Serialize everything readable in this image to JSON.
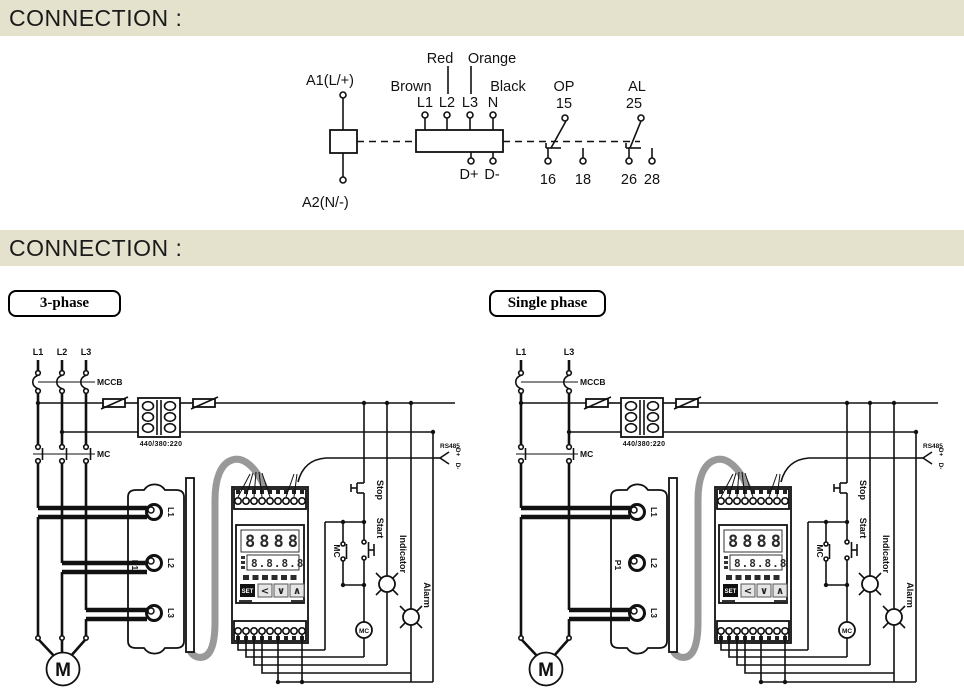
{
  "header": {
    "title": "CONNECTION :"
  },
  "section_tags": {
    "three_phase": "3-phase",
    "single_phase": "Single phase"
  },
  "top_diagram": {
    "supply_top": "A1(L/+)",
    "supply_bottom": "A2(N/-)",
    "color_brown": "Brown",
    "color_red": "Red",
    "color_orange": "Orange",
    "color_black": "Black",
    "t_l1": "L1",
    "t_l2": "L2",
    "t_l3": "L3",
    "t_n": "N",
    "t_dplus": "D+",
    "t_dminus": "D-",
    "op_label": "OP",
    "op_15": "15",
    "op_16": "16",
    "op_18": "18",
    "al_label": "AL",
    "al_25": "25",
    "al_26": "26",
    "al_28": "28"
  },
  "wiring": {
    "phase_l1": "L1",
    "phase_l2": "L2",
    "phase_l3": "L3",
    "mccb": "MCCB",
    "mc": "MC",
    "mc_aux": "MC",
    "mc_coil": "MC",
    "transformer_rating": "440/380:220",
    "ct_p1": "P1",
    "ring_l1": "L1",
    "ring_l2": "L2",
    "ring_l3": "L3",
    "rs485": "RS485",
    "rs485_dplus": "D+",
    "rs485_dminus": "D-",
    "stop": "Stop",
    "start": "Start",
    "indicator": "Indicator",
    "alarm": "Alarm",
    "motor": "M",
    "device": {
      "set": "SET",
      "left": "<",
      "down": "∨",
      "up": "∧",
      "row1": "8888",
      "row2": "8.8.8.8"
    }
  },
  "colors": {
    "header_bg": "#e4e2cd",
    "cable_gray": "#999999",
    "line": "#111111"
  }
}
